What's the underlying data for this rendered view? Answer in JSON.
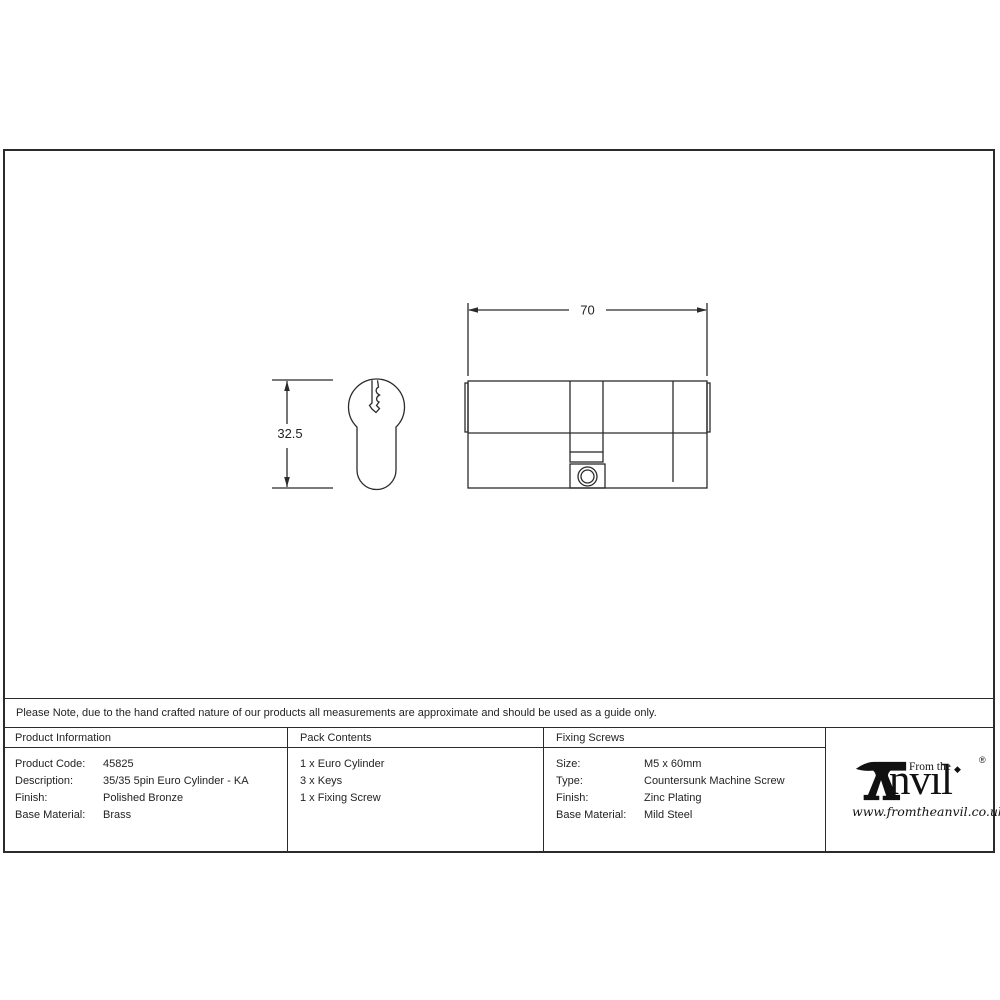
{
  "note": {
    "text": "Please Note, due to the hand crafted nature of our products all measurements are approximate and should be used as a guide only."
  },
  "drawing": {
    "dim_width": "70",
    "dim_height": "32.5"
  },
  "table": {
    "product_information": {
      "header": "Product Information",
      "rows": [
        {
          "label": "Product Code:",
          "value": "45825"
        },
        {
          "label": "Description:",
          "value": "35/35 5pin Euro Cylinder - KA"
        },
        {
          "label": "Finish:",
          "value": "Polished Bronze"
        },
        {
          "label": "Base Material:",
          "value": "Brass"
        }
      ]
    },
    "pack_contents": {
      "header": "Pack Contents",
      "items": [
        "1 x Euro Cylinder",
        "3 x Keys",
        "1 x Fixing Screw"
      ]
    },
    "fixing_screws": {
      "header": "Fixing Screws",
      "rows": [
        {
          "label": "Size:",
          "value": "M5 x 60mm"
        },
        {
          "label": "Type:",
          "value": "Countersunk Machine Screw"
        },
        {
          "label": "Finish:",
          "value": "Zinc Plating"
        },
        {
          "label": "Base Material:",
          "value": "Mild Steel"
        }
      ]
    }
  },
  "logo": {
    "prefix": "From the",
    "brand_rest": "nvıl",
    "tittle": "◆",
    "registered": "®",
    "website": "www.fromtheanvil.co.uk"
  },
  "colors": {
    "line": "#2b2b2b",
    "background": "#ffffff"
  }
}
